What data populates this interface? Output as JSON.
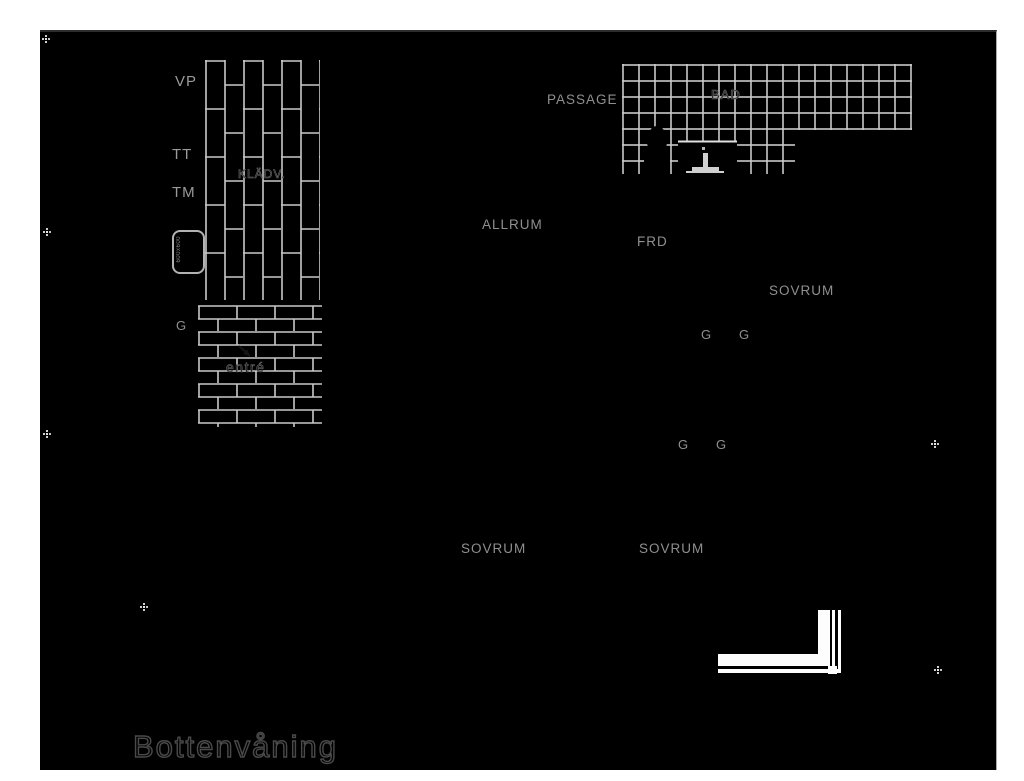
{
  "title": {
    "text": "Bottenvåning"
  },
  "drawing": {
    "page_background": "#ffffff",
    "background": "#000000",
    "hatch_line_color": "#c9c9c9",
    "label_color": "#8f8f8f",
    "title_outline_color": "#4a4a4a"
  },
  "labels": {
    "vp": "VP",
    "tt": "TT",
    "tm": "TM",
    "kladv": "KLÄDV.",
    "g": "G",
    "entre": "entré",
    "passage": "PASSAGE",
    "bad": "BAD",
    "allrum": "ALLRUM",
    "frd": "FRD",
    "sovrum": "SOVRUM"
  },
  "appliance": {
    "dimension_text": "600x600"
  },
  "icons": {
    "toilet": "toilet-silhouette",
    "washbasin": "washbasin-pedestal",
    "registration_mark": "dotted-cross",
    "entry_arrow": "diagonal-arrow"
  }
}
